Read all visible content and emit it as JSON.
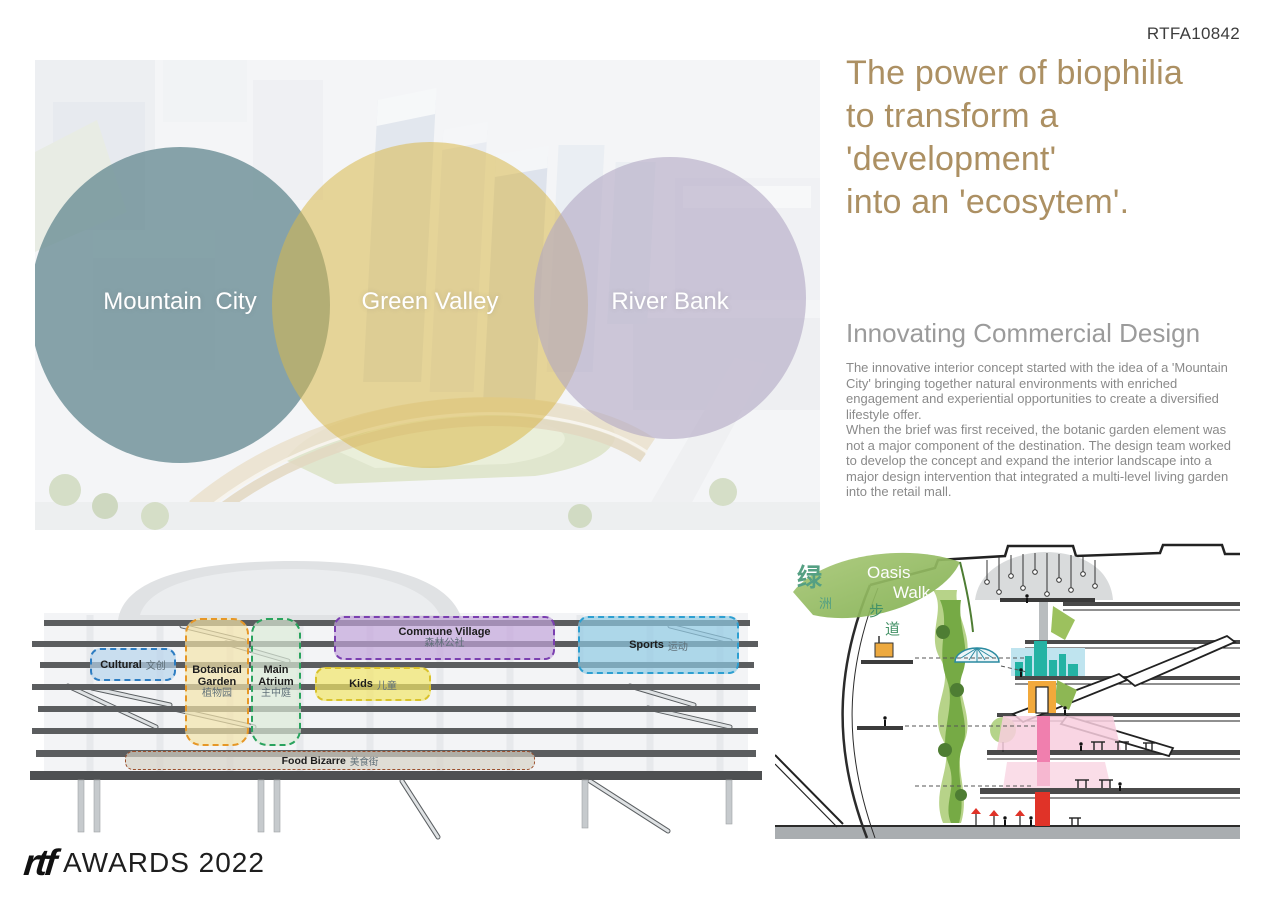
{
  "page": {
    "code": "RTFA10842"
  },
  "hero": {
    "circles": [
      {
        "id": "mountain-city",
        "label": "Mountain  City",
        "fill": "#6e9097",
        "opacity": 0.82
      },
      {
        "id": "green-valley",
        "label": "Green Valley",
        "fill": "#d8b84a",
        "opacity": 0.55
      },
      {
        "id": "river-bank",
        "label": "River Bank",
        "fill": "#b0a7c3",
        "opacity": 0.6
      }
    ]
  },
  "headline": {
    "lines": [
      "The power of biophilia",
      "to transform a",
      "'development'",
      "into an 'ecosytem'."
    ],
    "color": "#ac9063"
  },
  "article": {
    "title": "Innovating Commercial Design",
    "paragraphs": [
      "The innovative interior concept started with the idea of a 'Mountain City' bringing together natural environments with enriched engagement and experiential opportunities to create a diversified lifestyle offer.",
      "When the brief was first received, the botanic garden element was not a major component of the destination. The design team worked to develop the concept and expand the interior landscape into a major design intervention that integrated a multi-level living garden into the retail mall."
    ]
  },
  "zoning": {
    "zones": [
      {
        "id": "cultural",
        "label": "Cultural",
        "label_zh": "文创",
        "fill": "#b7d3ec",
        "border": "#2d7dc2"
      },
      {
        "id": "botanical-garden",
        "label": "Botanical Garden",
        "label_zh": "植物园",
        "fill": "#f4e4a9",
        "border": "#e69727"
      },
      {
        "id": "main-atrium",
        "label": "Main Atrium",
        "label_zh": "主中庭",
        "fill": "#dcebd8",
        "border": "#2aa35e"
      },
      {
        "id": "commune-village",
        "label": "Commune Village",
        "label_zh": "森林公社",
        "fill": "#c2a3db",
        "border": "#7a3fb0"
      },
      {
        "id": "kids",
        "label": "Kids",
        "label_zh": "儿童",
        "fill": "#f2e567",
        "border": "#d9c22c"
      },
      {
        "id": "sports",
        "label": "Sports",
        "label_zh": "运动",
        "fill": "#8ecae4",
        "border": "#2d9fd1"
      },
      {
        "id": "food-bizarre",
        "label": "Food Bizarre",
        "label_zh": "美食街",
        "fill": "#d7d2c6",
        "border": "#9c4f2c"
      }
    ]
  },
  "sketch": {
    "logo_en_line1": "Oasis",
    "logo_en_line2": "Walk",
    "logo_zh": [
      "绿",
      "洲",
      "步",
      "道"
    ]
  },
  "footer": {
    "logo": "rtf",
    "label": "AWARDS 2022"
  }
}
